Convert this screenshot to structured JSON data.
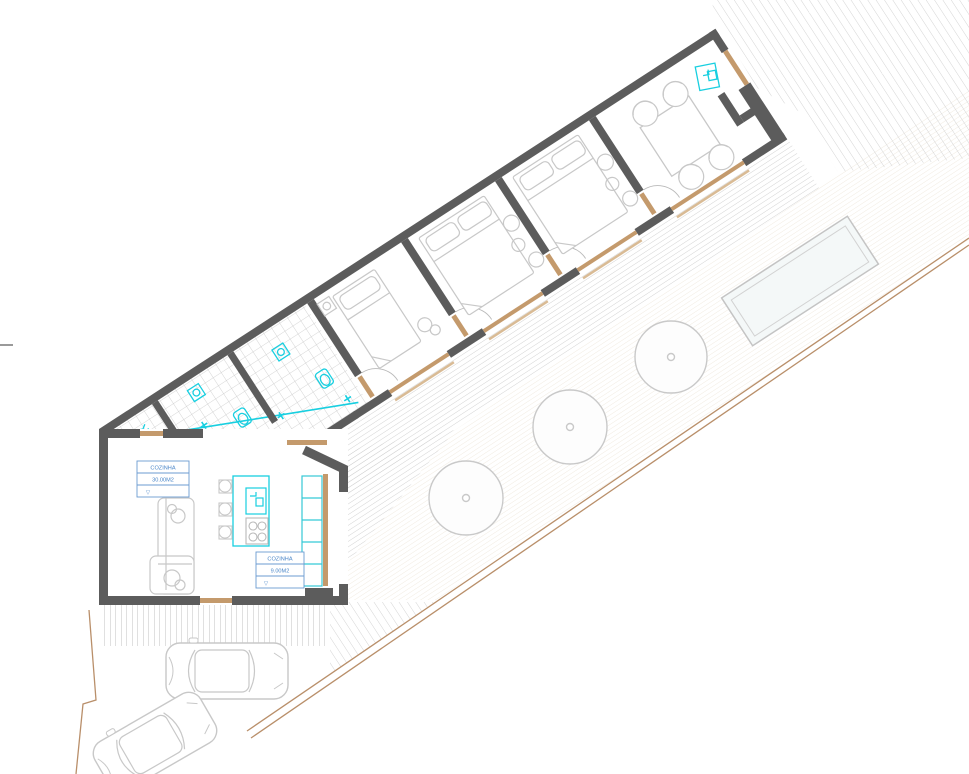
{
  "plan": {
    "type": "architectural-floor-plan",
    "labels": {
      "kitchen_main": {
        "line1": "COZINHA",
        "line2": "30.00M2",
        "line3": "▽"
      },
      "kitchen_small": {
        "line1": "COZINHA",
        "line2": "9.00M2",
        "line3": "▽"
      }
    },
    "colors": {
      "wall": "#5c5c5c",
      "wood_trim": "#c49a6c",
      "fixture_cyan": "#18cfe0",
      "label_blue": "#4a86c8",
      "boundary_tan": "#b98f6a",
      "hatch_gray": "#d6d6d6",
      "furniture_gray": "#c8c8c8",
      "pool_fill": "#f4f8f8"
    },
    "features": {
      "bedrooms": 3,
      "bathrooms": 2,
      "trees": 3,
      "cars": 2,
      "pools": 1
    },
    "icons": {
      "toilet-icon": "wall-hung toilet",
      "sink-icon": "washbasin",
      "shower-icon": "shower head",
      "stove-icon": "4-burner cooktop",
      "tree-icon": "tree canopy circle",
      "pool-icon": "swimming pool",
      "car-icon": "car top view"
    }
  }
}
